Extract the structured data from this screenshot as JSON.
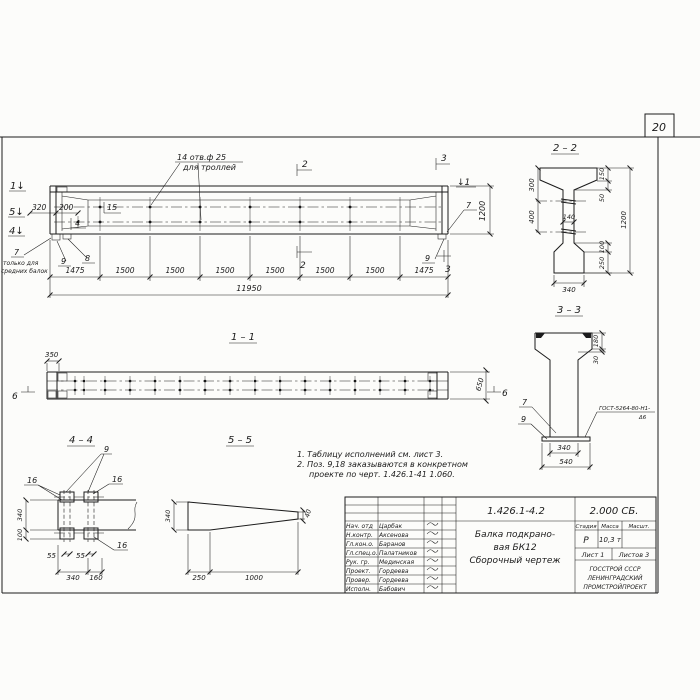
{
  "sheet": {
    "number": "20"
  },
  "elevation": {
    "marks": {
      "m1l": "1↓",
      "m5": "5↓",
      "m4": "4↓",
      "m1r": "↓1",
      "m2": "2",
      "m3": "3"
    },
    "dims": {
      "d320": "320",
      "d200": "200",
      "d1200": "1200",
      "total": "11950",
      "segments": [
        "1475",
        "1500",
        "1500",
        "1500",
        "1500",
        "1500",
        "1500",
        "1475"
      ]
    },
    "holes_note": {
      "line1": "14 отв.ф 25",
      "line2": "для троллей"
    },
    "pos": {
      "p15": "15",
      "p4": "4",
      "p7": "7",
      "p8": "8",
      "p9": "9"
    },
    "note7": {
      "line1": "только для",
      "line2": "средних балок"
    },
    "right": {
      "p7": "7",
      "p9": "9"
    }
  },
  "section11": {
    "title": "1 – 1",
    "d350": "350",
    "d650": "650",
    "mark6": "6"
  },
  "section22": {
    "title": "2 – 2",
    "d300": "300",
    "d400": "400",
    "d150": "150",
    "d50": "50",
    "d140": "140",
    "d1200": "1200",
    "d100": "100",
    "d250": "250",
    "d340": "340"
  },
  "section33": {
    "title": "3 – 3",
    "d180": "180",
    "d30": "30",
    "d340": "340",
    "d540": "540",
    "p7": "7",
    "p9": "9",
    "weld1": "ГОСТ-5264-80-Н1-",
    "weld2": "Δ6"
  },
  "section44": {
    "title": "4 – 4",
    "p9": "9",
    "p16": "16",
    "d340": "340",
    "d100": "100",
    "d55": "55",
    "d340b": "340",
    "d160": "160"
  },
  "section55": {
    "title": "5 – 5",
    "d340": "340",
    "d40": "40",
    "d250": "250",
    "d1000": "1000"
  },
  "notes": {
    "line1": "1. Таблицу исполнений см. лист 3.",
    "line2": "2. Поз. 9,18 заказываются в конкретном",
    "line3": "проекте по черт. 1.426.1-41 1.060."
  },
  "titleblock": {
    "doc_number": "1.426.1-4.2",
    "doc_code": "2.000 СБ.",
    "title_line1": "Балка подкрано-",
    "title_line2": "вая БК12",
    "title_line3": "Сборочный чертеж",
    "col_stage": "Стадия",
    "col_mass": "Масса",
    "col_scale": "Масшт.",
    "stage": "Р",
    "mass": "10,3 т",
    "sheet_label": "Лист 1",
    "sheets_label": "Листов 3",
    "org_line1": "ГОССТРОЙ СССР",
    "org_line2": "ЛЕНИНГРАДСКИЙ",
    "org_line3": "ПРОМСТРОЙПРОЕКТ",
    "rows": [
      {
        "role": "Нач. отд",
        "name": "Царбак"
      },
      {
        "role": "Н.контр.",
        "name": "Аксенова"
      },
      {
        "role": "Гл.кон.о.",
        "name": "Баранов"
      },
      {
        "role": "Гл.спец.о.",
        "name": "Палатников"
      },
      {
        "role": "Рук. гр.",
        "name": "Мединская"
      },
      {
        "role": "Проект.",
        "name": "Гордеева"
      },
      {
        "role": "Провер.",
        "name": "Гордеева"
      },
      {
        "role": "Исполн.",
        "name": "Бабович"
      }
    ]
  }
}
